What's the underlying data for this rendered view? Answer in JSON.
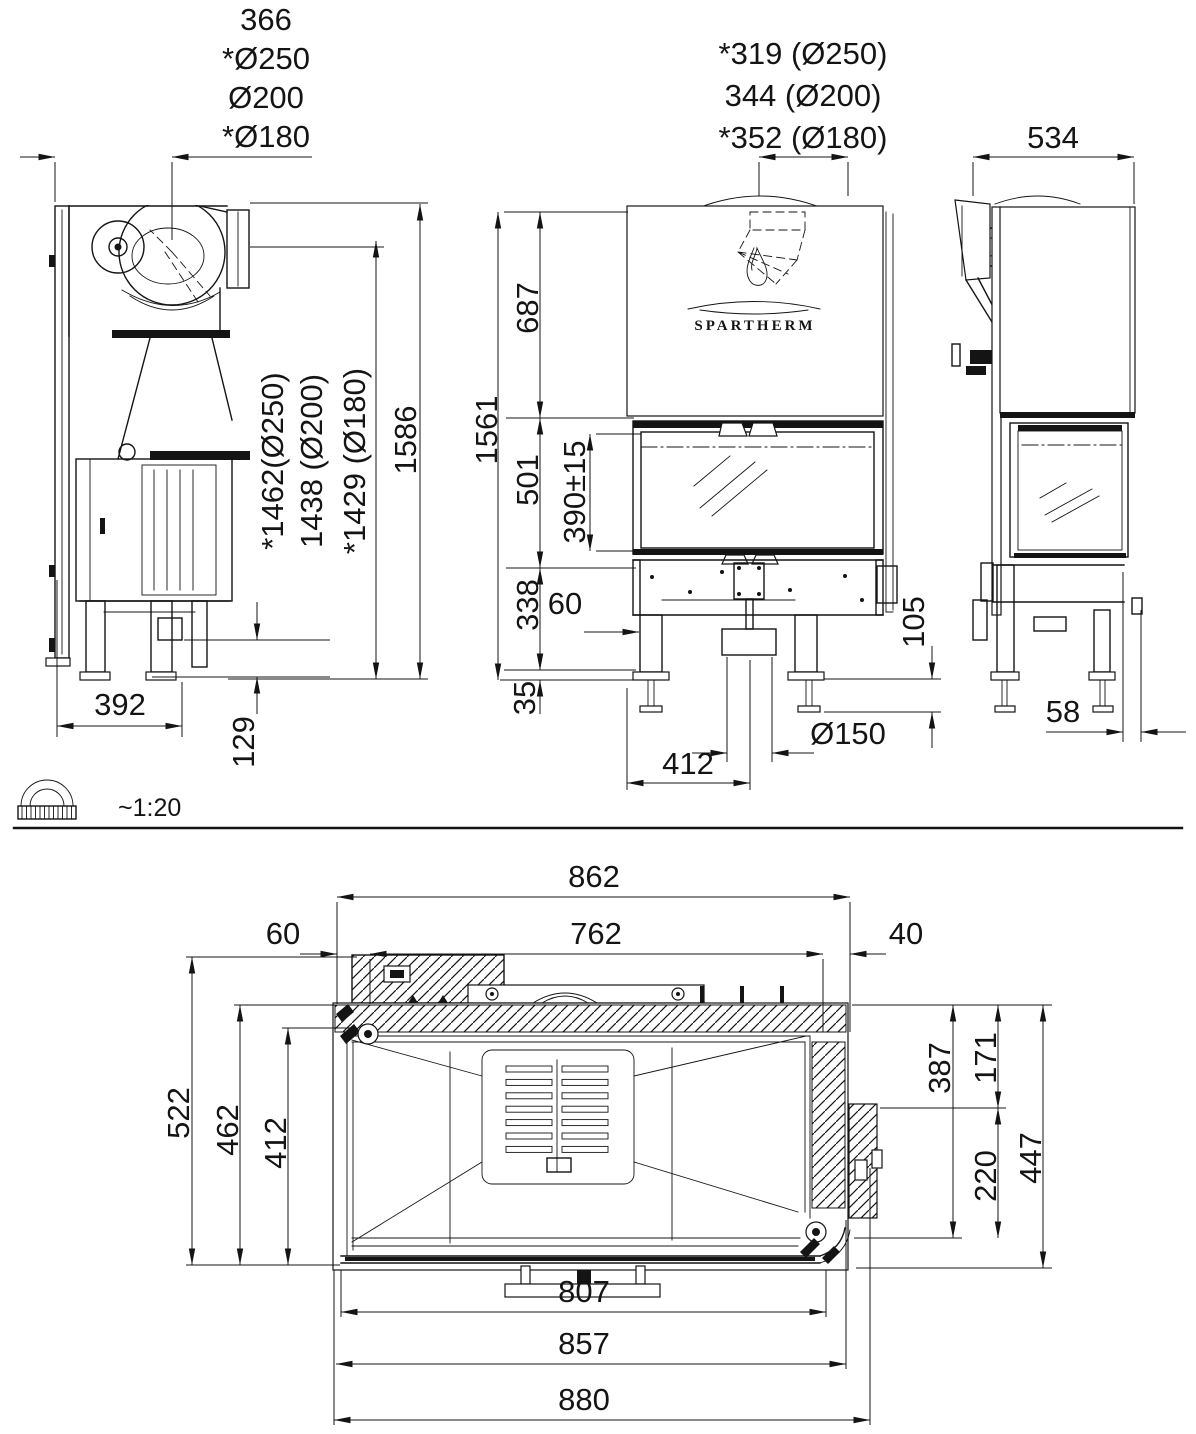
{
  "drawing": {
    "brand": "SPARTHERM",
    "scale_note": "~1:20",
    "line_color": "#141414",
    "background": "#ffffff"
  },
  "side_view": {
    "flue_offset_labels": [
      "366",
      "*Ø250",
      "Ø200",
      "*Ø180"
    ],
    "flue_height_labels": [
      "*1462(Ø250)",
      "1438 (Ø200)",
      "*1429 (Ø180)"
    ],
    "overall_height": "1586",
    "base_depth": "392",
    "base_clearance": "129"
  },
  "front_view": {
    "flue_offset_labels": [
      "*319 (Ø250)",
      "344 (Ø200)",
      "*352 (Ø180)"
    ],
    "upper_section_height": "687",
    "overall_height": "1561",
    "door_height": "501",
    "glass_height": "390±15",
    "base_section_height": "338",
    "floor_clearance": "35",
    "leg_inset": "60",
    "leg_adjust_height": "105",
    "air_inlet_diameter": "Ø150",
    "air_inlet_offset": "412"
  },
  "right_view": {
    "depth": "534",
    "rear_foot_offset": "58"
  },
  "plan_view": {
    "outer_width": "862",
    "inner_width": "762",
    "left_offset": "60",
    "right_offset": "40",
    "total_depth": "522",
    "inner_depth": "462",
    "firebox_depth": "412",
    "right_depth_a": "387",
    "right_depth_b": "171",
    "right_depth_c": "220",
    "right_depth_total": "447",
    "glass_width": "807",
    "body_width": "857",
    "max_width": "880"
  }
}
